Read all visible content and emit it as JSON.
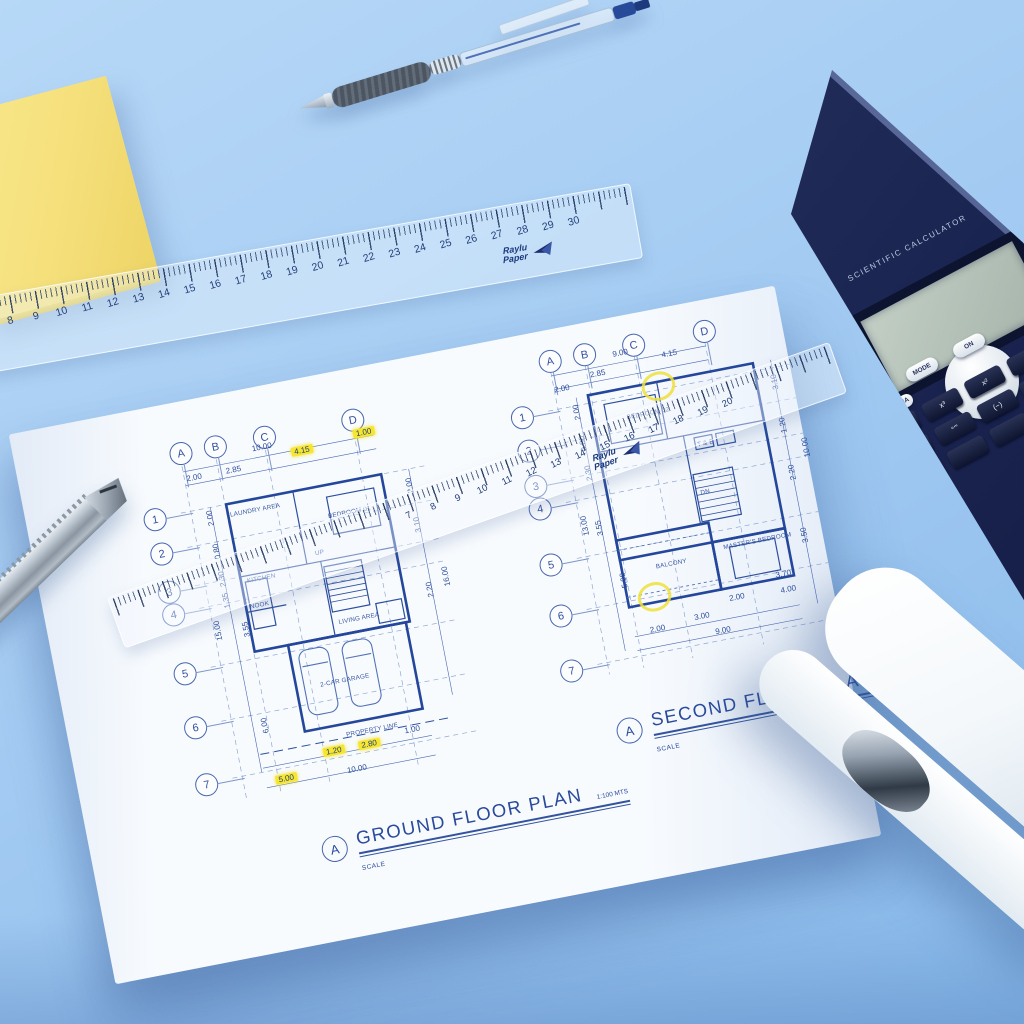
{
  "colors": {
    "desk_top": "#b7d8f7",
    "desk_bottom": "#88b9ea",
    "paper": "#f8fbfe",
    "blueprint_ink": "#2c4c9c",
    "highlight_yellow": "#f6e62e",
    "sticky_note_yellow": "#f5e07c",
    "calculator_body": "#1a2450",
    "calculator_screen": "#aeb9b0",
    "stapler_white": "#f4f8fb",
    "knife_metal": "#aab4bf",
    "pen_ink_blue": "#274a99"
  },
  "top_ruler": {
    "numbers": [
      "8",
      "9",
      "10",
      "11",
      "12",
      "13",
      "14",
      "15",
      "16",
      "17",
      "18",
      "19",
      "20",
      "21",
      "22",
      "23",
      "24",
      "25",
      "26",
      "27",
      "28",
      "29",
      "30"
    ],
    "brand_top": "Raylu",
    "brand_bottom": "Paper"
  },
  "paper_ruler": {
    "numbers": [
      "7",
      "8",
      "9",
      "10",
      "11",
      "12",
      "13",
      "14",
      "15",
      "16",
      "17",
      "18",
      "19",
      "20"
    ],
    "brand_top": "Raylu",
    "brand_bottom": "Paper"
  },
  "calculator": {
    "label": "SCIENTIFIC CALCULATOR",
    "alpha_key": "ALPHA",
    "pill_keys": [
      {
        "t": "MODE",
        "x": 905,
        "y": 362
      },
      {
        "t": "ON",
        "x": 952,
        "y": 338
      }
    ],
    "dark_keys": [
      "RCL",
      "x³",
      "x²",
      "√",
      "a b/c",
      "°’”",
      "(−)",
      "RCL",
      "",
      "",
      "",
      ""
    ]
  },
  "ground_plan": {
    "title_bubble": "A",
    "title": "GROUND FLOOR PLAN",
    "scale_label": "SCALE",
    "scale_value": "1:100 MTS",
    "col_bubbles": [
      {
        "t": "A",
        "x": 4,
        "y": 0
      },
      {
        "t": "B",
        "x": 39,
        "y": 0
      },
      {
        "t": "C",
        "x": 89,
        "y": 0
      },
      {
        "t": "D",
        "x": 179,
        "y": 0
      }
    ],
    "row_bubbles": [
      {
        "t": "1",
        "x": -34,
        "y": 60
      },
      {
        "t": "2",
        "x": -34,
        "y": 95
      },
      {
        "t": "3",
        "x": -34,
        "y": 134
      },
      {
        "t": "4",
        "x": -34,
        "y": 157
      },
      {
        "t": "5",
        "x": -34,
        "y": 217
      },
      {
        "t": "6",
        "x": -34,
        "y": 272
      },
      {
        "t": "7",
        "x": -34,
        "y": 330
      }
    ],
    "dims": [
      {
        "t": "10.00",
        "x": 86,
        "y": 16
      },
      {
        "t": "2.00",
        "x": 16,
        "y": 33
      },
      {
        "t": "2.85",
        "x": 56,
        "y": 33
      },
      {
        "t": "4.15",
        "x": 124,
        "y": 27,
        "hl": true
      },
      {
        "t": "1.00",
        "x": 188,
        "y": 21,
        "hl": true
      },
      {
        "t": "2.00",
        "x": 24,
        "y": 76,
        "rot": -90
      },
      {
        "t": "0.80",
        "x": 24,
        "y": 110,
        "rot": -90
      },
      {
        "t": "2.30",
        "x": 24,
        "y": 138,
        "rot": -90
      },
      {
        "t": "1.35",
        "x": 24,
        "y": 160,
        "rot": -90
      },
      {
        "t": "15.00",
        "x": 8,
        "y": 188,
        "rot": -90
      },
      {
        "t": "3.55",
        "x": 38,
        "y": 192,
        "rot": -90
      },
      {
        "t": "6.00",
        "x": 38,
        "y": 290,
        "rot": -90
      },
      {
        "t": "2.00",
        "x": 226,
        "y": 82,
        "rot": -90
      },
      {
        "t": "3.10",
        "x": 226,
        "y": 122,
        "rot": -90
      },
      {
        "t": "2.20",
        "x": 226,
        "y": 188,
        "rot": -90
      },
      {
        "t": "16.00",
        "x": 242,
        "y": 178,
        "rot": -90
      },
      {
        "t": "1.20",
        "x": 98,
        "y": 328,
        "hl": true
      },
      {
        "t": "2.80",
        "x": 134,
        "y": 328,
        "hl": true
      },
      {
        "t": "1.00",
        "x": 182,
        "y": 322
      },
      {
        "t": "5.00",
        "x": 46,
        "y": 346,
        "hl": true
      },
      {
        "t": "10.00",
        "x": 118,
        "y": 350
      }
    ],
    "rooms": [
      {
        "t": "LAUNDRY AREA",
        "x": 52,
        "y": 78
      },
      {
        "t": "KITCHEN",
        "x": 56,
        "y": 146
      },
      {
        "t": "NOOK",
        "x": 54,
        "y": 172
      },
      {
        "t": "BEDROOM 01",
        "x": 148,
        "y": 98
      },
      {
        "t": "UP",
        "x": 128,
        "y": 132
      },
      {
        "t": "LIVING AREA",
        "x": 138,
        "y": 204
      },
      {
        "t": "2-CAR GARAGE",
        "x": 108,
        "y": 262
      },
      {
        "t": "PROPERTY LINE",
        "x": 124,
        "y": 316
      }
    ]
  },
  "second_plan": {
    "title_bubble": "A",
    "title": "SECOND FLOOR PLAN",
    "scale_label": "SCALE",
    "col_bubbles": [
      {
        "t": "A",
        "x": 4,
        "y": 0
      },
      {
        "t": "B",
        "x": 39,
        "y": 0
      },
      {
        "t": "C",
        "x": 89,
        "y": 0
      },
      {
        "t": "D",
        "x": 161,
        "y": 0
      }
    ],
    "row_bubbles": [
      {
        "t": "1",
        "x": -34,
        "y": 50
      },
      {
        "t": "2",
        "x": -34,
        "y": 84
      },
      {
        "t": "3",
        "x": -34,
        "y": 120
      },
      {
        "t": "4",
        "x": -34,
        "y": 143
      },
      {
        "t": "5",
        "x": -34,
        "y": 200
      },
      {
        "t": "6",
        "x": -34,
        "y": 252
      },
      {
        "t": "7",
        "x": -34,
        "y": 308
      }
    ],
    "dims": [
      {
        "t": "9.00",
        "x": 78,
        "y": 12
      },
      {
        "t": "2.85",
        "x": 52,
        "y": 28
      },
      {
        "t": "4.15",
        "x": 126,
        "y": 22
      },
      {
        "t": "2.00",
        "x": 14,
        "y": 36
      },
      {
        "t": "2.00",
        "x": 24,
        "y": 62,
        "rot": -90
      },
      {
        "t": "0.80",
        "x": 24,
        "y": 94,
        "rot": -90
      },
      {
        "t": "2.30",
        "x": 24,
        "y": 124,
        "rot": -90
      },
      {
        "t": "13.00",
        "x": 8,
        "y": 175,
        "rot": -90
      },
      {
        "t": "3.55",
        "x": 24,
        "y": 180,
        "rot": -90
      },
      {
        "t": "5.00",
        "x": 38,
        "y": 236,
        "rot": -90
      },
      {
        "t": "3.10",
        "x": 224,
        "y": 70,
        "rot": -90
      },
      {
        "t": "1.20",
        "x": 224,
        "y": 114,
        "rot": -90
      },
      {
        "t": "10.00",
        "x": 240,
        "y": 140,
        "rot": -90
      },
      {
        "t": "2.20",
        "x": 224,
        "y": 162,
        "rot": -90
      },
      {
        "t": "3.50",
        "x": 224,
        "y": 226,
        "rot": -90
      },
      {
        "t": "2.00",
        "x": 62,
        "y": 290
      },
      {
        "t": "3.00",
        "x": 108,
        "y": 286
      },
      {
        "t": "9.00",
        "x": 126,
        "y": 304
      },
      {
        "t": "2.00",
        "x": 146,
        "y": 274
      },
      {
        "t": "3.70",
        "x": 196,
        "y": 260
      },
      {
        "t": "4.00",
        "x": 198,
        "y": 276
      }
    ],
    "rooms": [
      {
        "t": "BEDROOM 02",
        "x": 80,
        "y": 78
      },
      {
        "t": "T & B",
        "x": 144,
        "y": 118
      },
      {
        "t": "DN",
        "x": 138,
        "y": 166
      },
      {
        "t": "MASTER'S BEDROOM",
        "x": 150,
        "y": 224
      },
      {
        "t": "BALCONY",
        "x": 80,
        "y": 230
      }
    ],
    "annotations": [
      {
        "x": 100,
        "y": 42
      },
      {
        "x": 56,
        "y": 248
      }
    ]
  }
}
